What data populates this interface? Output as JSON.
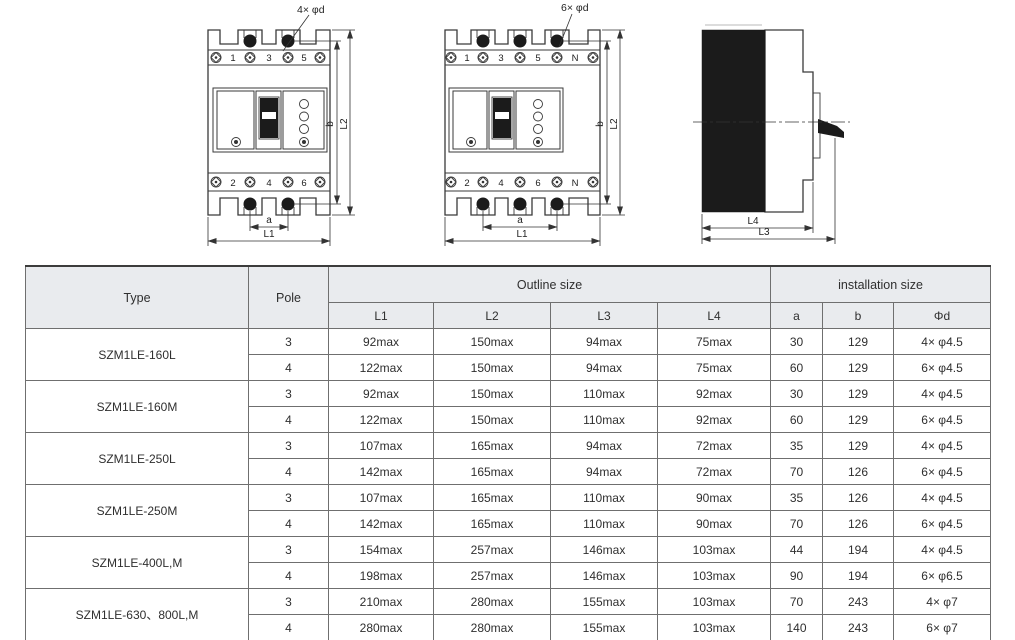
{
  "drawings": {
    "front3": {
      "hole_label": "4× φd",
      "top_terminals": [
        "1",
        "3",
        "5"
      ],
      "bottom_terminals": [
        "2",
        "4",
        "6"
      ],
      "dim_a": "a",
      "dim_l1": "L1",
      "dim_b": "b",
      "dim_l2": "L2"
    },
    "front4": {
      "hole_label": "6× φd",
      "top_terminals": [
        "1",
        "3",
        "5",
        "N"
      ],
      "bottom_terminals": [
        "2",
        "4",
        "6",
        "N"
      ],
      "dim_a": "a",
      "dim_l1": "L1",
      "dim_b": "b",
      "dim_l2": "L2"
    },
    "side": {
      "dim_l4": "L4",
      "dim_l3": "L3"
    }
  },
  "table": {
    "header": {
      "type": "Type",
      "pole": "Pole",
      "outline_size": "Outline size",
      "installation_size": "installation size",
      "sub_headers": [
        "L1",
        "L2",
        "L3",
        "L4",
        "a",
        "b",
        "Φd"
      ]
    },
    "groups": [
      {
        "type": "SZM1LE-160L",
        "rows": [
          [
            "3",
            "92max",
            "150max",
            "94max",
            "75max",
            "30",
            "129",
            "4× φ4.5"
          ],
          [
            "4",
            "122max",
            "150max",
            "94max",
            "75max",
            "60",
            "129",
            "6× φ4.5"
          ]
        ]
      },
      {
        "type": "SZM1LE-160M",
        "rows": [
          [
            "3",
            "92max",
            "150max",
            "110max",
            "92max",
            "30",
            "129",
            "4× φ4.5"
          ],
          [
            "4",
            "122max",
            "150max",
            "110max",
            "92max",
            "60",
            "129",
            "6× φ4.5"
          ]
        ]
      },
      {
        "type": "SZM1LE-250L",
        "rows": [
          [
            "3",
            "107max",
            "165max",
            "94max",
            "72max",
            "35",
            "129",
            "4× φ4.5"
          ],
          [
            "4",
            "142max",
            "165max",
            "94max",
            "72max",
            "70",
            "126",
            "6× φ4.5"
          ]
        ]
      },
      {
        "type": "SZM1LE-250M",
        "rows": [
          [
            "3",
            "107max",
            "165max",
            "110max",
            "90max",
            "35",
            "126",
            "4× φ4.5"
          ],
          [
            "4",
            "142max",
            "165max",
            "110max",
            "90max",
            "70",
            "126",
            "6× φ4.5"
          ]
        ]
      },
      {
        "type": "SZM1LE-400L,M",
        "rows": [
          [
            "3",
            "154max",
            "257max",
            "146max",
            "103max",
            "44",
            "194",
            "4× φ4.5"
          ],
          [
            "4",
            "198max",
            "257max",
            "146max",
            "103max",
            "90",
            "194",
            "6× φ6.5"
          ]
        ]
      },
      {
        "type": "SZM1LE-630、800L,M",
        "rows": [
          [
            "3",
            "210max",
            "280max",
            "155max",
            "103max",
            "70",
            "243",
            "4× φ7"
          ],
          [
            "4",
            "280max",
            "280max",
            "155max",
            "103max",
            "140",
            "243",
            "6× φ7"
          ]
        ]
      }
    ]
  },
  "colors": {
    "header_bg": "#e9ebee",
    "border": "#6f6f6f",
    "ink": "#2f2f2f",
    "drawing_black": "#1b1b1b"
  }
}
